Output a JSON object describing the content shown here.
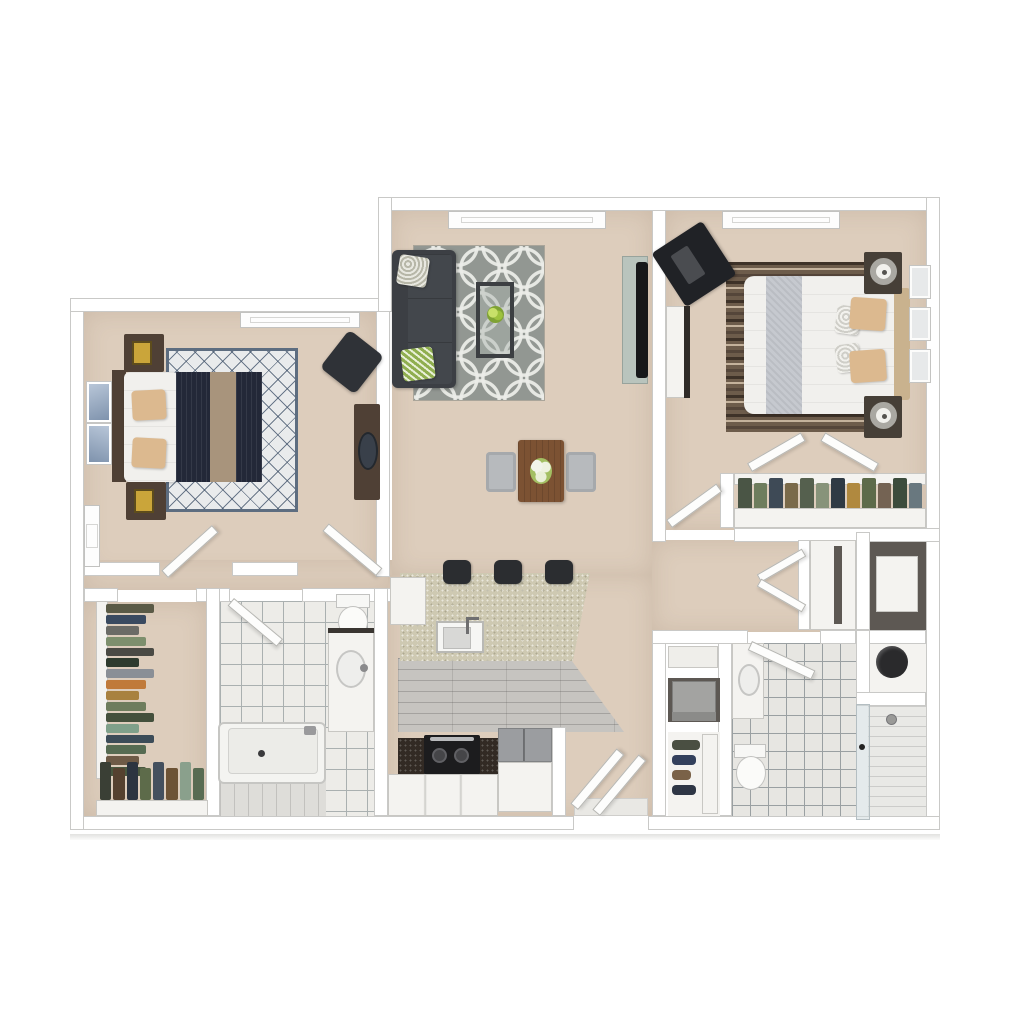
{
  "scene": {
    "type": "3d-floor-plan-rendering-top-down",
    "apartment": {
      "bedrooms": 2,
      "bathrooms": 2
    },
    "rooms": [
      {
        "id": "living-room",
        "furniture": [
          "charcoal-sofa",
          "accent-pillows",
          "trellis-area-rug",
          "glass-coffee-table-with-plant",
          "tv-console",
          "window"
        ]
      },
      {
        "id": "dining-area",
        "furniture": [
          "wood-dining-table",
          "two-gray-chairs",
          "flower-centerpiece"
        ]
      },
      {
        "id": "kitchen",
        "furniture": [
          "granite-breakfast-bar",
          "three-bar-stools",
          "sink",
          "range-cooktop",
          "refrigerator",
          "base-cabinets",
          "wood-plank-floor"
        ]
      },
      {
        "id": "bedroom-1",
        "furniture": [
          "bed-navy-duvet-tan-runner",
          "diamond-lattice-rug",
          "two-nightstands",
          "gold-lamps",
          "blue-wall-art",
          "desk-chair",
          "console-with-mirror",
          "two-windows"
        ]
      },
      {
        "id": "bedroom-2",
        "furniture": [
          "bed-white-duvet-gray-runner",
          "tan-headboard",
          "striped-brown-rug",
          "two-nightstands",
          "drum-lamps",
          "corner-tv-stand",
          "bookcase",
          "three-wall-frames",
          "bifold-closet-with-clothes",
          "window"
        ]
      },
      {
        "id": "bathroom-1",
        "furniture": [
          "bathtub",
          "toilet",
          "vanity-sink",
          "tile-floor"
        ]
      },
      {
        "id": "bathroom-2",
        "furniture": [
          "vanity-sink",
          "toilet",
          "stacked-washer-dryer",
          "shoe-shelves",
          "tile-floor"
        ]
      },
      {
        "id": "shower-room",
        "furniture": [
          "walk-in-shower",
          "glass-door"
        ]
      },
      {
        "id": "walk-in-closet",
        "furniture": [
          "hanging-clothes-left-rod",
          "hanging-clothes-bottom-rod",
          "shelving"
        ]
      },
      {
        "id": "hallway",
        "furniture": [
          "double-door-linen-closet",
          "laundry-storage-closet",
          "water-heater-closet"
        ]
      },
      {
        "id": "entry",
        "furniture": [
          "entry-double-door",
          "door-mat"
        ]
      }
    ]
  },
  "palette": {
    "background": "#ffffff",
    "wall": "#ffffff",
    "wall_outline": "#c9c9c7",
    "carpet": "#ddcdbc",
    "tile": "#edece8",
    "tile_line": "#aab0b0",
    "tile2": "#e7e6e2",
    "tile2_line": "#9aa0a2",
    "plank_kitchen": "#c6c4c0",
    "granite": "#cec9b2",
    "cabinet_white": "#f4f3f0",
    "sofa": "#3c3f44",
    "rug_living": "#929792",
    "rug_bed1_bg": "#e9ebec",
    "duvet_navy": "#232838",
    "runner_tan": "#a8947c",
    "mattress_white": "#f1f0ed",
    "pillow_tan": "#dcb98f",
    "wood_dark": "#4f4035",
    "table_brown": "#7c5233",
    "chair_gray": "#b7babd",
    "rug_bed2_base": "#6d5c4b",
    "rug_bed2_dark": "#3e3228",
    "rug_bed2_light": "#c4b29c",
    "headboard_tan": "#c9b28e",
    "runner_gray": "#c6c9cf",
    "tv_black": "#17181a",
    "console_sage": "#b9c4bd",
    "fridge_gray": "#9b9da0",
    "stove_black": "#1c1c1e",
    "entry_mat": "#e9e8e4",
    "art_blue_light": "#b8c6d8",
    "art_blue_dark": "#7f93ad",
    "lamp_gold": "#caa53a",
    "heater_black": "#2a2a2c"
  },
  "closets": {
    "walk_in_left": [
      "#5a5a46",
      "#3a4a60",
      "#6b6b66",
      "#7d8f6d",
      "#4a4a44",
      "#2e3b2e",
      "#8a8f96",
      "#c07a3a",
      "#a8813f",
      "#6e7d5d",
      "#44503c",
      "#7fa08a",
      "#3c4c58",
      "#566b52",
      "#6e5a46",
      "#49573f"
    ],
    "walk_in_bottom": [
      "#3a3f35",
      "#55412f",
      "#2c3440",
      "#5d6b4a",
      "#44505e",
      "#6d5335",
      "#8aa08c",
      "#586b52"
    ],
    "bedroom2_closet": [
      "#4a5545",
      "#6e7d5d",
      "#3e4a56",
      "#7a6a4a",
      "#55604e",
      "#87937a",
      "#2f3a44",
      "#b0893f",
      "#5d6b4a",
      "#746353",
      "#3c4c3c",
      "#69787f"
    ],
    "bath2_shoes": [
      "#4a4f42",
      "#33405c",
      "#7a6248",
      "#2e3645"
    ]
  }
}
